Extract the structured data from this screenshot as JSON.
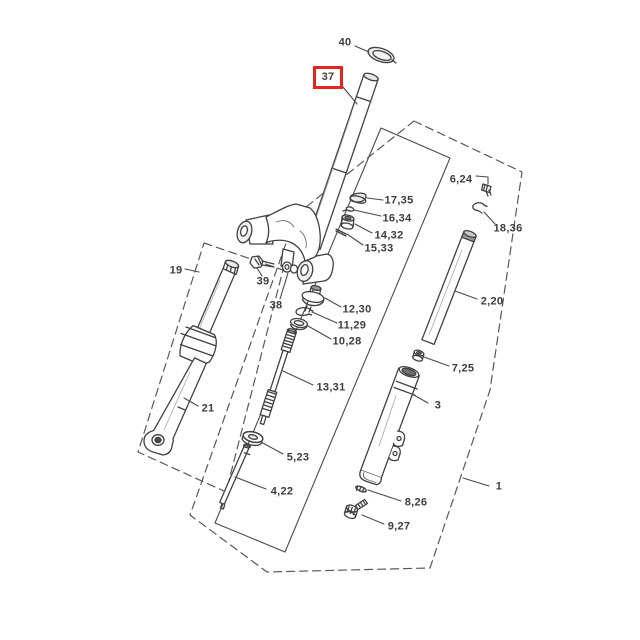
{
  "diagram": {
    "type": "exploded-parts-diagram",
    "highlighted_part": "37",
    "highlight_color": "#e3251c",
    "line_color": "#404040",
    "labels": [
      {
        "id": "40",
        "text": "40"
      },
      {
        "id": "37",
        "text": "37"
      },
      {
        "id": "17-35",
        "text": "17,35"
      },
      {
        "id": "16-34",
        "text": "16,34"
      },
      {
        "id": "14-32",
        "text": "14,32"
      },
      {
        "id": "15-33",
        "text": "15,33"
      },
      {
        "id": "12-30",
        "text": "12,30"
      },
      {
        "id": "11-29",
        "text": "11,29"
      },
      {
        "id": "10-28",
        "text": "10,28"
      },
      {
        "id": "38",
        "text": "38"
      },
      {
        "id": "39",
        "text": "39"
      },
      {
        "id": "19",
        "text": "19"
      },
      {
        "id": "21",
        "text": "21"
      },
      {
        "id": "13-31",
        "text": "13,31"
      },
      {
        "id": "5-23",
        "text": "5,23"
      },
      {
        "id": "4-22",
        "text": "4,22"
      },
      {
        "id": "6-24",
        "text": "6,24"
      },
      {
        "id": "18-36",
        "text": "18,36"
      },
      {
        "id": "2-20",
        "text": "2,20"
      },
      {
        "id": "7-25",
        "text": "7,25"
      },
      {
        "id": "3",
        "text": "3"
      },
      {
        "id": "8-26",
        "text": "8,26"
      },
      {
        "id": "9-27",
        "text": "9,27"
      },
      {
        "id": "1",
        "text": "1"
      }
    ]
  }
}
